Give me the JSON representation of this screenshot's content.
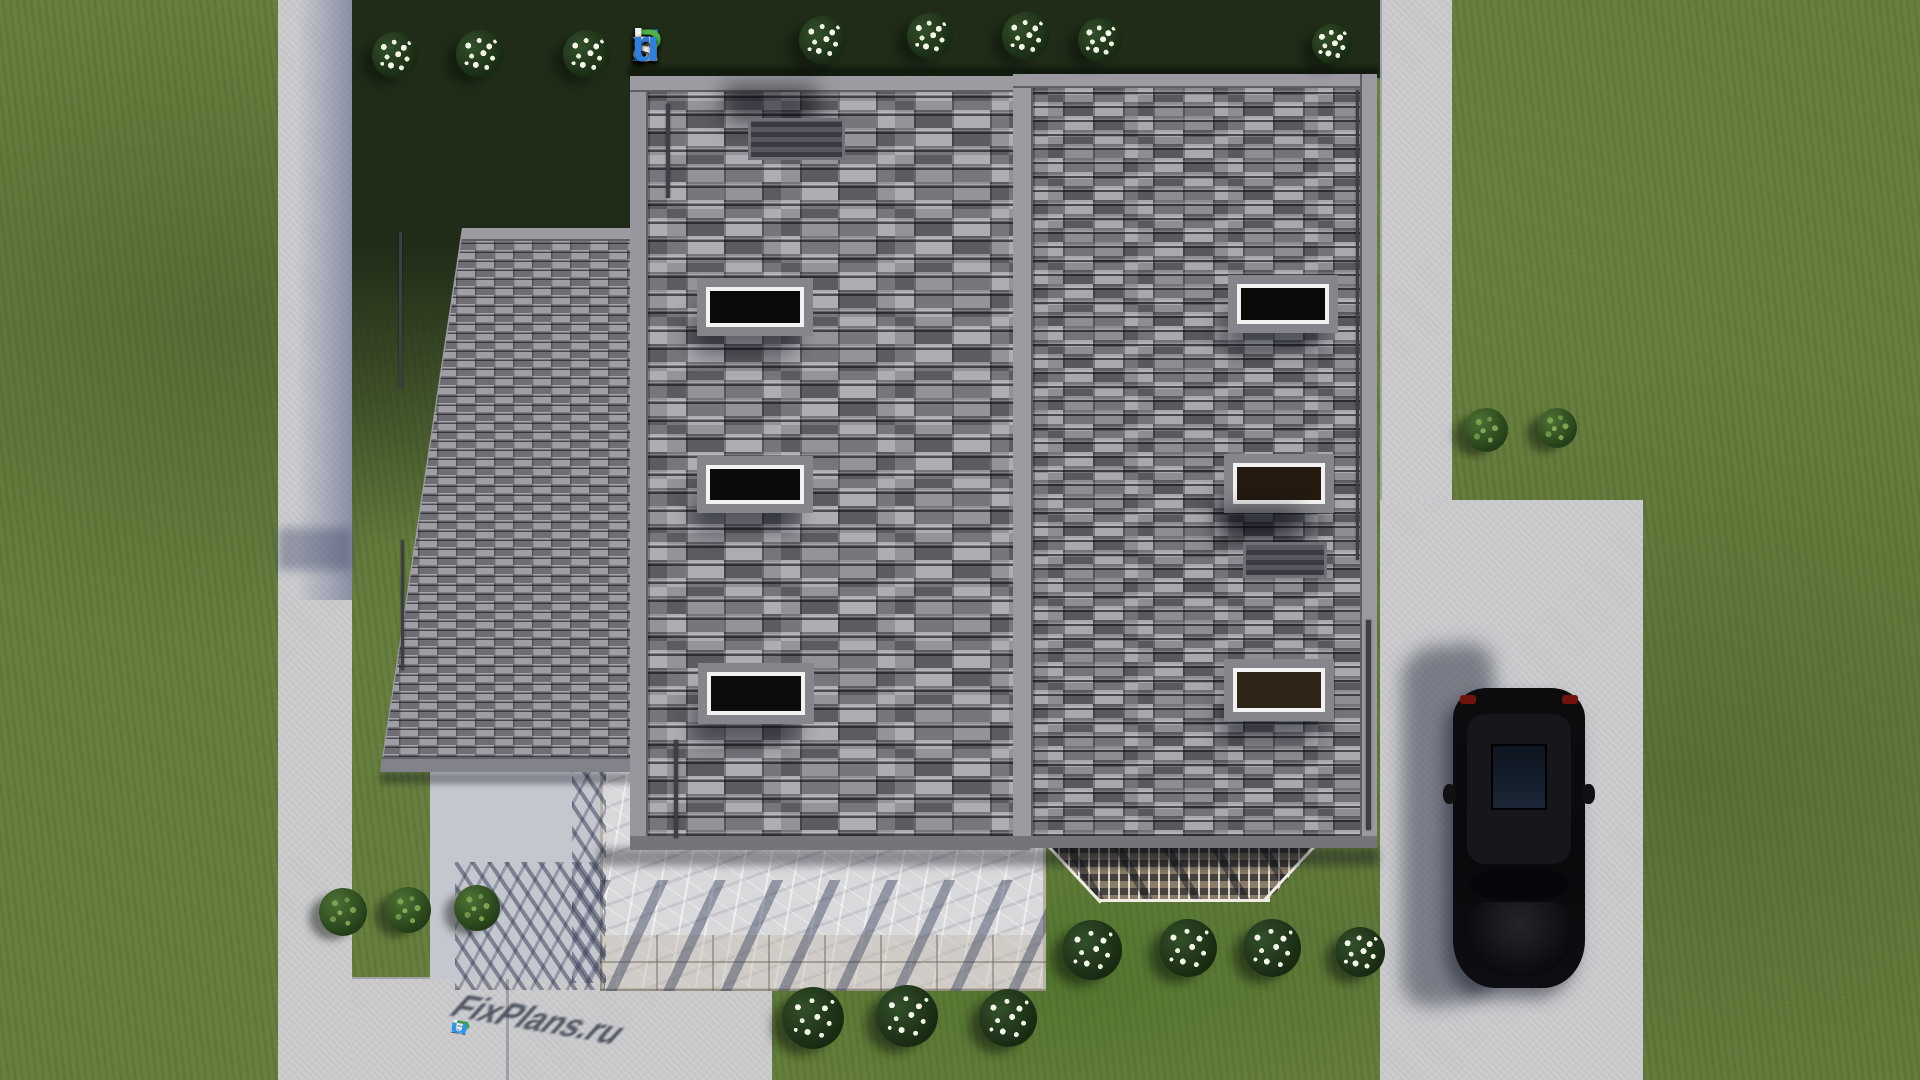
{
  "branding": {
    "logo_text": "FixPlans.ru",
    "logo_letters": [
      {
        "ch": "F",
        "color": "#2d7fe0"
      },
      {
        "ch": "i",
        "color": "#f2f2f2"
      },
      {
        "ch": "x",
        "color": "#f2f2f2"
      },
      {
        "ch": "P",
        "color": "#4db24a"
      },
      {
        "ch": "l",
        "color": "#f2f2f2"
      },
      {
        "ch": "a",
        "color": "#f2f2f2"
      },
      {
        "ch": "n",
        "color": "#f2f2f2"
      },
      {
        "ch": "s",
        "color": "#f2f2f2"
      },
      {
        "ch": ".",
        "color": "#2d7fe0"
      },
      {
        "ch": "r",
        "color": "#2d7fe0"
      },
      {
        "ch": "u",
        "color": "#2d7fe0"
      }
    ],
    "watermark_text": "FixPlans.ru",
    "watermark_letters": [
      {
        "ch": "F",
        "color": "#2196f3"
      },
      {
        "ch": "i",
        "color": "#43a047"
      },
      {
        "ch": "x",
        "color": "#ececec"
      },
      {
        "ch": "P",
        "color": "#43a047"
      },
      {
        "ch": "l",
        "color": "#ececec"
      },
      {
        "ch": "a",
        "color": "#ececec"
      },
      {
        "ch": "n",
        "color": "#ececec"
      },
      {
        "ch": "s",
        "color": "#ececec"
      },
      {
        "ch": ".",
        "color": "#2196f3"
      },
      {
        "ch": "r",
        "color": "#ececec"
      },
      {
        "ch": "u",
        "color": "#2196f3"
      }
    ]
  },
  "colors": {
    "lawn": "#677f3e",
    "lawn_shadow": "#202c18",
    "lawn_bright": "#406e22",
    "walkway": "#cbcbce",
    "walkway_shadow": "#9aa0bc",
    "roof_tile_light": "#9c9ca2",
    "roof_tile_dark": "#55555c",
    "roof_trim": "#9b9ba1",
    "patio_marble": "#d9d9dc",
    "pergola_wood": "#8a7c66",
    "skylight_frame": "#f2f2f2",
    "skylight_glass": "#0c0c0c",
    "car_body": "#0b0b0e",
    "car_taillight": "#71130c",
    "logo_blue": "#2d7fe0",
    "logo_green": "#4db24a",
    "logo_white": "#f2f2f2"
  },
  "house": {
    "skylights": [
      {
        "x": 706,
        "y": 287,
        "w": 98,
        "h": 40,
        "glass": "#0a0a0a"
      },
      {
        "x": 706,
        "y": 465,
        "w": 98,
        "h": 39,
        "glass": "#0a0a0a"
      },
      {
        "x": 707,
        "y": 672,
        "w": 98,
        "h": 43,
        "glass": "#0c0c0c"
      },
      {
        "x": 1237,
        "y": 284,
        "w": 92,
        "h": 40,
        "glass": "#0c0a08"
      },
      {
        "x": 1233,
        "y": 463,
        "w": 92,
        "h": 41,
        "glass": "#241a10"
      },
      {
        "x": 1233,
        "y": 668,
        "w": 92,
        "h": 44,
        "glass": "#2e2418"
      }
    ],
    "chimneys": [
      {
        "x": 748,
        "y": 118,
        "w": 97,
        "h": 42
      },
      {
        "x": 1243,
        "y": 542,
        "w": 84,
        "h": 36
      }
    ],
    "gutters": [
      {
        "x": 666,
        "y": 104,
        "w": 4,
        "h": 94
      },
      {
        "x": 674,
        "y": 740,
        "w": 4,
        "h": 98
      },
      {
        "x": 399,
        "y": 232,
        "w": 3,
        "h": 156
      },
      {
        "x": 401,
        "y": 540,
        "w": 3,
        "h": 130
      },
      {
        "x": 1356,
        "y": 90,
        "w": 3,
        "h": 470
      },
      {
        "x": 1366,
        "y": 620,
        "w": 5,
        "h": 210
      }
    ]
  },
  "landscape": {
    "flower_bushes": [
      {
        "x": 395,
        "y": 55,
        "d": 46
      },
      {
        "x": 480,
        "y": 54,
        "d": 48
      },
      {
        "x": 587,
        "y": 54,
        "d": 48
      },
      {
        "x": 823,
        "y": 40,
        "d": 48
      },
      {
        "x": 930,
        "y": 36,
        "d": 46
      },
      {
        "x": 1026,
        "y": 36,
        "d": 48
      },
      {
        "x": 1100,
        "y": 40,
        "d": 44
      },
      {
        "x": 1332,
        "y": 44,
        "d": 40
      },
      {
        "x": 1092,
        "y": 950,
        "d": 60
      },
      {
        "x": 1188,
        "y": 948,
        "d": 58
      },
      {
        "x": 1272,
        "y": 948,
        "d": 58
      },
      {
        "x": 1360,
        "y": 952,
        "d": 50
      },
      {
        "x": 813,
        "y": 1018,
        "d": 62
      },
      {
        "x": 907,
        "y": 1016,
        "d": 62
      },
      {
        "x": 1008,
        "y": 1018,
        "d": 58
      }
    ],
    "green_bushes": [
      {
        "x": 343,
        "y": 912,
        "d": 48
      },
      {
        "x": 408,
        "y": 910,
        "d": 46
      },
      {
        "x": 477,
        "y": 908,
        "d": 46
      },
      {
        "x": 1486,
        "y": 430,
        "d": 44
      },
      {
        "x": 1557,
        "y": 428,
        "d": 40
      }
    ],
    "car": {
      "color": "black",
      "x": 1453,
      "y": 688,
      "w": 132,
      "h": 300
    }
  }
}
